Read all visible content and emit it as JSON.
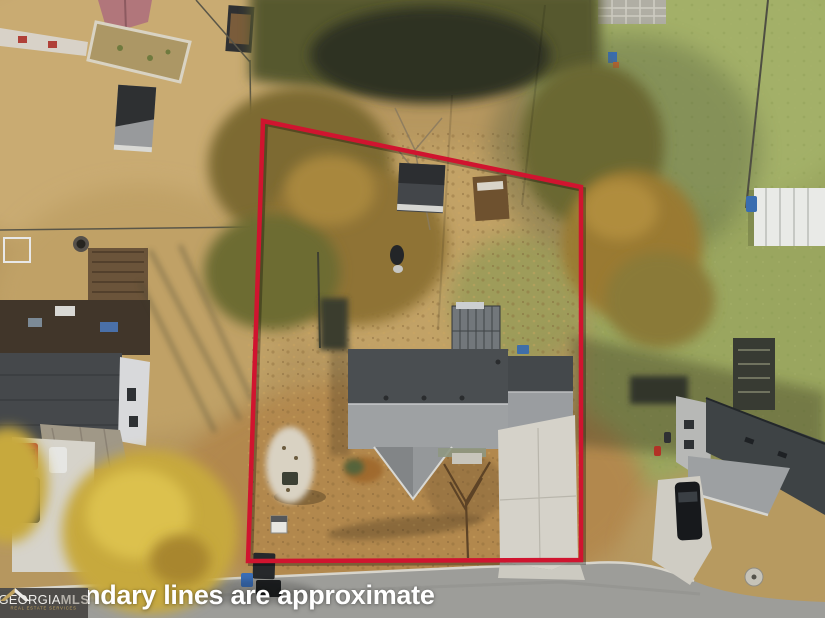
{
  "watermark": {
    "text": "ndary lines are approximate"
  },
  "logo": {
    "primary": "GEORGIA",
    "secondary": "MLS",
    "tagline": "REAL ESTATE SERVICES"
  },
  "boundary": {
    "points": "263,121 581,187 581,560 248,561",
    "color": "#d0142f"
  },
  "icons": {
    "logo_roof": "roof-gable-icon"
  },
  "colors": {
    "boundary-red": "#d0142f",
    "road-gray": "#9d9d99",
    "concrete-light": "#d5d2c9",
    "roof-dark": "#4a4e51",
    "roof-light": "#9ea1a3",
    "lawn-tan": "#b6975f",
    "lawn-green": "#9aa65f",
    "autumn-orange": "#9a7a33",
    "yellow-tree": "#c7a93c",
    "logo-bg": "#4a4845",
    "logo-gold": "#c2a35c",
    "watermark-white": "#ffffff"
  }
}
